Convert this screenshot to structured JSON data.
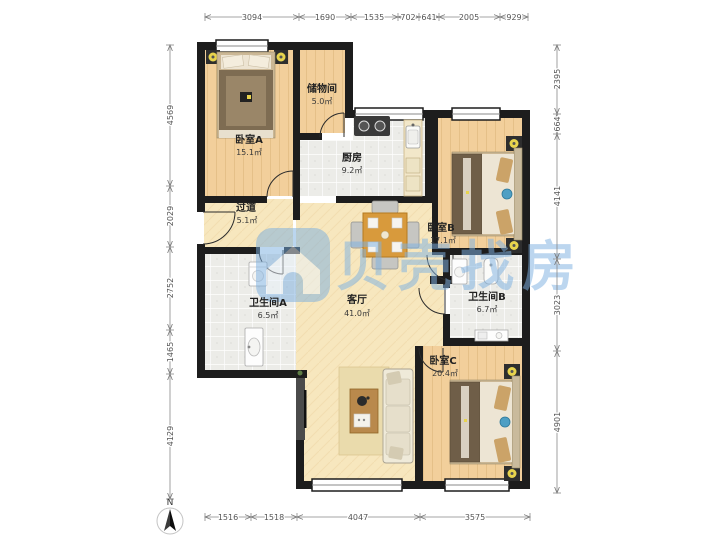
{
  "watermark": {
    "logo": "beike-house-logo",
    "text": "贝壳找房",
    "color": "#79AEE0"
  },
  "compass": {
    "label": "N"
  },
  "rooms": [
    {
      "id": "bedroom-a",
      "name": "卧室A",
      "area": "15.1㎡"
    },
    {
      "id": "storage",
      "name": "储物间",
      "area": "5.0㎡"
    },
    {
      "id": "kitchen",
      "name": "厨房",
      "area": "9.2㎡"
    },
    {
      "id": "bedroom-b",
      "name": "卧室B",
      "area": "17.1㎡"
    },
    {
      "id": "hallway",
      "name": "过道",
      "area": "5.1㎡"
    },
    {
      "id": "bathroom-a",
      "name": "卫生间A",
      "area": "6.5㎡"
    },
    {
      "id": "living-room",
      "name": "客厅",
      "area": "41.0㎡"
    },
    {
      "id": "bathroom-b",
      "name": "卫生间B",
      "area": "6.7㎡"
    },
    {
      "id": "bedroom-c",
      "name": "卧室C",
      "area": "20.4㎡"
    }
  ],
  "dimensions": {
    "top": [
      "3094",
      "1690",
      "1535",
      "702",
      "641",
      "2005",
      "929"
    ],
    "left": [
      "4569",
      "2029",
      "2752",
      "1465",
      "4129"
    ],
    "right": [
      "2395",
      "664",
      "4141",
      "3023",
      "4901"
    ],
    "bottom": [
      "1516",
      "1518",
      "4047",
      "3575"
    ]
  },
  "colors": {
    "wall": "#1D1D1D",
    "wood_floor": "#F2CF9B",
    "wood_floor_light": "#F7E7BE",
    "tile_floor": "#ECECE8",
    "watermark_blue": "#79AEE0",
    "accent_yellow": "#E8D44D",
    "dimension_text": "#555555"
  }
}
